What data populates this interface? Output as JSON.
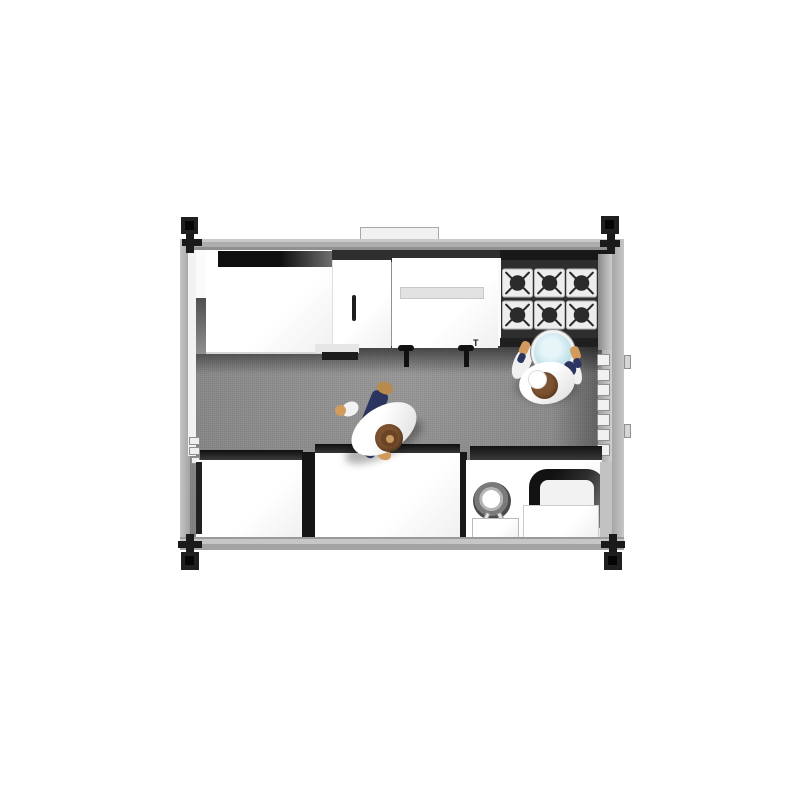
{
  "labels": {
    "valve_mark": "T"
  },
  "colors": {
    "background": "#ffffff",
    "wall": "#b0b0b0",
    "floor": "#8f8f8f",
    "counter": "#ffffff",
    "deep_shadow": "#141414",
    "stove_body": "#2e2e2e",
    "burner_plate": "#ededed",
    "burner_ring": "#2b2b2b",
    "corner_post": "#1f1f1f",
    "bowl": "#c9e6ee",
    "uniform": "#f6f6f6",
    "pants": "#2c3460",
    "skin": "#d29a5c",
    "hair": "#7d5230",
    "shoe": "#b98a4e"
  },
  "scene": {
    "type": "top-down 3D render of a modular container kitchen",
    "room": {
      "walls": 4,
      "corner_posts": 4,
      "roof_vent_tabs": 1
    },
    "appliances": [
      {
        "name": "prep-counter-top-left"
      },
      {
        "name": "tall-cabinet-with-handle"
      },
      {
        "name": "fryer-unit",
        "gas_valves": 2
      },
      {
        "name": "gas-range",
        "burners": 6,
        "burner_rows": 2,
        "burner_cols": 3
      },
      {
        "name": "right-wall-shelf",
        "bins": 7
      },
      {
        "name": "left-wall-shelf",
        "boxes": 3
      },
      {
        "name": "counter-bottom-left"
      },
      {
        "name": "counter-bottom-middle"
      },
      {
        "name": "equipment-station-bottom-right",
        "items": [
          "mixer-ring",
          "mixer-stand-box",
          "rounded-dark-machine",
          "white-box"
        ]
      }
    ],
    "people": [
      {
        "name": "chef-at-stove",
        "holding": "blue-bowl",
        "hat": "white"
      },
      {
        "name": "chef-walking-midfloor",
        "pose": "striding"
      }
    ]
  }
}
